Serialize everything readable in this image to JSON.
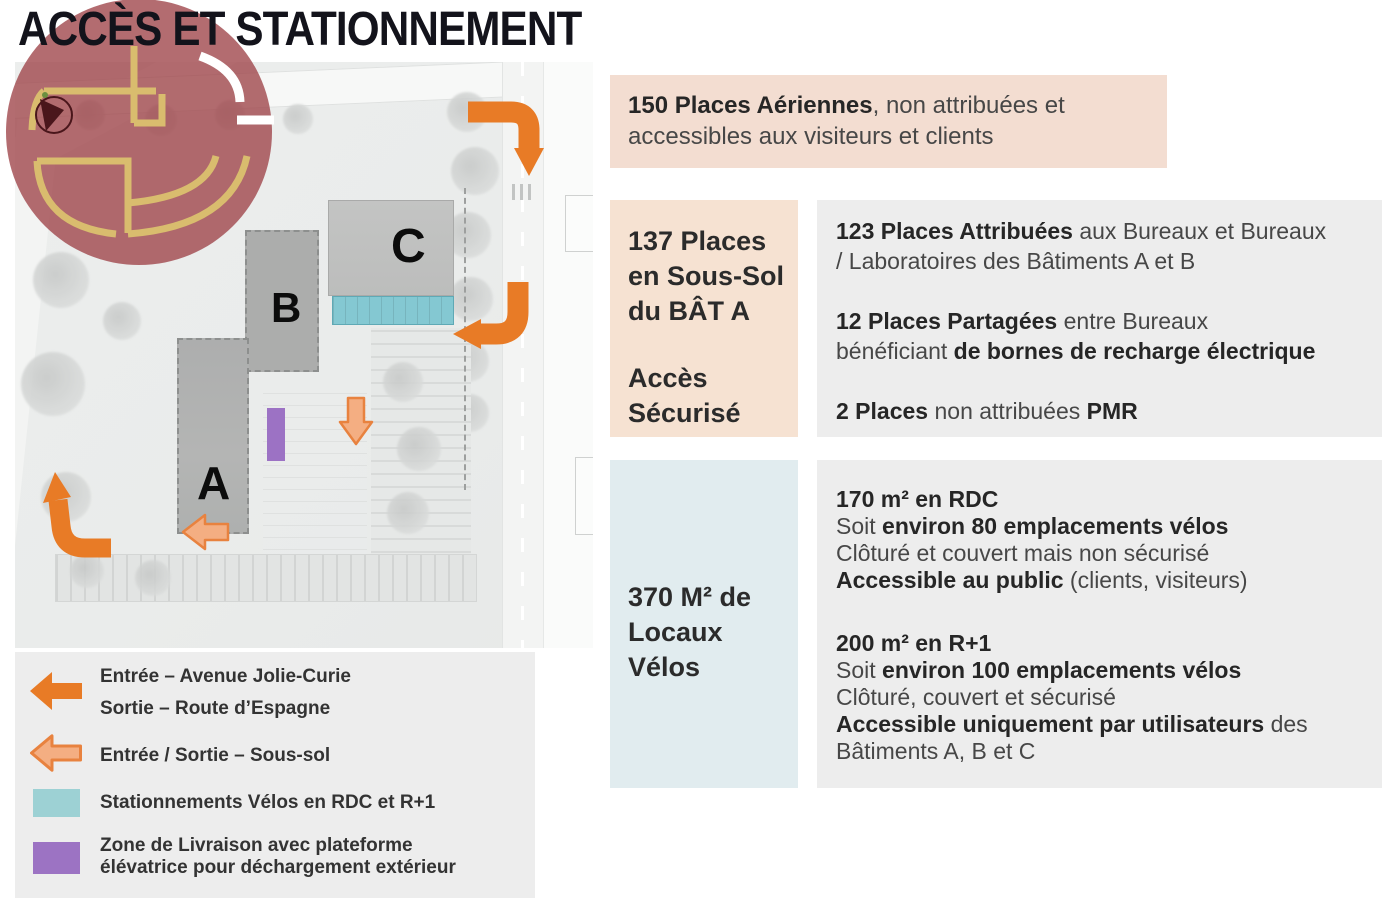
{
  "title": "ACCÈS ET STATIONNEMENT",
  "colors": {
    "accent_orange": "#e87b26",
    "accent_orange_light": "#f4ae82",
    "peach_box": "#f3ddd1",
    "peach_box2": "#f6e2d2",
    "gray_box": "#ededed",
    "blue_box": "#e1ecef",
    "teal": "#9dd1d4",
    "purple": "#9c73c3",
    "logo_red": "#9e4348",
    "logo_gold": "#d9bc6e"
  },
  "map": {
    "buildings": [
      {
        "label": "A"
      },
      {
        "label": "B"
      },
      {
        "label": "C"
      }
    ]
  },
  "info_boxes": {
    "aerial": {
      "lines": [
        [
          {
            "t": "150 Places Aériennes",
            "b": true
          },
          {
            "t": ", non attribuées et",
            "b": false
          }
        ],
        [
          {
            "t": "accessibles aux visiteurs et clients",
            "b": false
          }
        ]
      ]
    },
    "underground": {
      "title_lines": [
        "137 Places",
        "en Sous-Sol",
        "du BÂT A"
      ],
      "subtitle_lines": [
        "Accès",
        "Sécurisé"
      ],
      "details": [
        [
          [
            {
              "t": "123 Places Attribuées",
              "b": true
            },
            {
              "t": " aux Bureaux et Bureaux",
              "b": false
            }
          ],
          [
            {
              "t": "/ Laboratoires des Bâtiments A et B",
              "b": false
            }
          ]
        ],
        [
          [
            {
              "t": "12 Places Partagées",
              "b": true
            },
            {
              "t": " entre Bureaux",
              "b": false
            }
          ],
          [
            {
              "t": "bénéficiant ",
              "b": false
            },
            {
              "t": "de bornes de recharge électrique",
              "b": true
            }
          ]
        ],
        [
          [
            {
              "t": "2 Places",
              "b": true
            },
            {
              "t": " non attribuées ",
              "b": false
            },
            {
              "t": "PMR",
              "b": true
            }
          ]
        ]
      ]
    },
    "bikes": {
      "title_lines": [
        "370 M² de",
        "Locaux",
        "Vélos"
      ],
      "details": [
        [
          [
            {
              "t": "170 m² en RDC",
              "b": true
            }
          ],
          [
            {
              "t": "Soit ",
              "b": false
            },
            {
              "t": "environ 80 emplacements vélos",
              "b": true
            }
          ],
          [
            {
              "t": "Clôturé et couvert mais non sécurisé",
              "b": false
            }
          ],
          [
            {
              "t": "Accessible au public",
              "b": true
            },
            {
              "t": " (clients, visiteurs)",
              "b": false
            }
          ]
        ],
        [
          [
            {
              "t": "200 m² en R+1",
              "b": true
            }
          ],
          [
            {
              "t": "Soit ",
              "b": false
            },
            {
              "t": "environ 100 emplacements vélos",
              "b": true
            }
          ],
          [
            {
              "t": "Clôturé, couvert et sécurisé",
              "b": false
            }
          ],
          [
            {
              "t": "Accessible uniquement par utilisateurs",
              "b": true
            },
            {
              "t": " des",
              "b": false
            }
          ],
          [
            {
              "t": "Bâtiments A, B et C",
              "b": false
            }
          ]
        ]
      ]
    }
  },
  "legend": {
    "items": [
      {
        "icon": "entry-arrow-solid",
        "lines": [
          "Entrée – Avenue Jolie-Curie",
          "Sortie – Route d’Espagne"
        ]
      },
      {
        "icon": "entry-exit-arrow-outline",
        "lines": [
          "Entrée / Sortie – Sous-sol"
        ]
      },
      {
        "icon": "teal-swatch",
        "lines": [
          "Stationnements Vélos en RDC et R+1"
        ]
      },
      {
        "icon": "purple-swatch",
        "lines": [
          "Zone de Livraison avec plateforme",
          "élévatrice pour déchargement extérieur"
        ]
      }
    ]
  }
}
